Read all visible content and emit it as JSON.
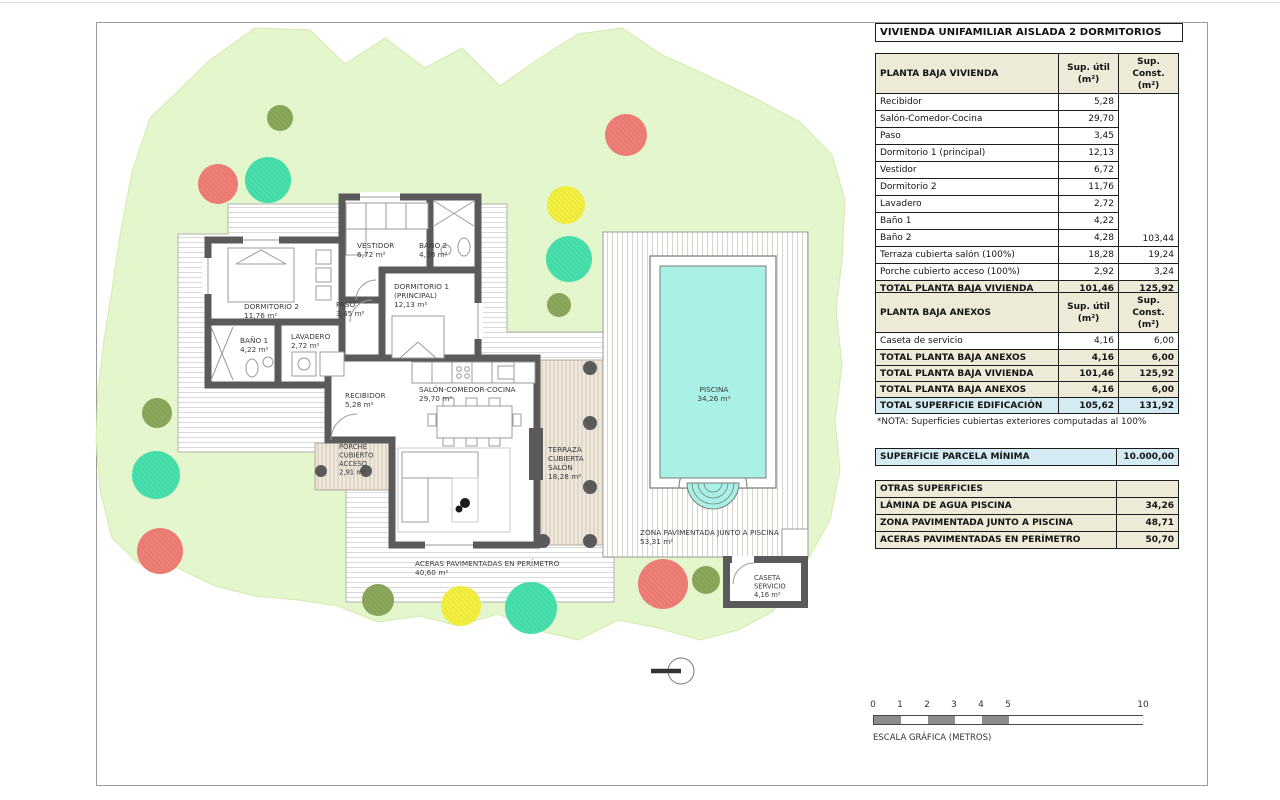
{
  "sheet": {
    "title": "VIVIENDA UNIFAMILIAR AISLADA 2 DORMITORIOS"
  },
  "tables": {
    "vivienda": {
      "widths": [
        183,
        60,
        60
      ],
      "header": [
        "PLANTA BAJA VIVIENDA",
        "Sup. útil\n(m²)",
        "Sup. Const.\n(m²)"
      ],
      "merge": {
        "col": 2,
        "rows": 9,
        "value": "103,44"
      },
      "rows": [
        {
          "c": [
            "Recibidor",
            "5,28",
            ""
          ]
        },
        {
          "c": [
            "Salón-Comedor-Cocina",
            "29,70",
            ""
          ]
        },
        {
          "c": [
            "Paso",
            "3,45",
            ""
          ]
        },
        {
          "c": [
            "Dormitorio 1 (principal)",
            "12,13",
            ""
          ]
        },
        {
          "c": [
            "Vestidor",
            "6,72",
            ""
          ]
        },
        {
          "c": [
            "Dormitorio 2",
            "11,76",
            ""
          ]
        },
        {
          "c": [
            "Lavadero",
            "2,72",
            ""
          ]
        },
        {
          "c": [
            "Baño 1",
            "4,22",
            ""
          ]
        },
        {
          "c": [
            "Baño 2",
            "4,28",
            ""
          ]
        },
        {
          "c": [
            "Terraza cubierta salón (100%)",
            "18,28",
            "19,24"
          ]
        },
        {
          "c": [
            "Porche cubierto acceso (100%)",
            "2,92",
            "3,24"
          ]
        },
        {
          "c": [
            "TOTAL PLANTA BAJA VIVIENDA",
            "101,46",
            "125,92"
          ],
          "s": "cream"
        }
      ]
    },
    "anexos": {
      "widths": [
        183,
        60,
        60
      ],
      "header": [
        "PLANTA BAJA ANEXOS",
        "Sup. útil\n(m²)",
        "Sup. Const.\n(m²)"
      ],
      "rows": [
        {
          "c": [
            "Caseta de servicio",
            "4,16",
            "6,00"
          ]
        },
        {
          "c": [
            "TOTAL PLANTA BAJA ANEXOS",
            "4,16",
            "6,00"
          ],
          "s": "cream"
        }
      ]
    },
    "totales": {
      "widths": [
        183,
        60,
        60
      ],
      "rows": [
        {
          "c": [
            "TOTAL PLANTA BAJA VIVIENDA",
            "101,46",
            "125,92"
          ],
          "s": "cream"
        },
        {
          "c": [
            "TOTAL PLANTA BAJA ANEXOS",
            "4,16",
            "6,00"
          ],
          "s": "cream"
        },
        {
          "c": [
            "TOTAL SUPERFICIE EDIFICACIÓN",
            "105,62",
            "131,92"
          ],
          "s": "blue"
        }
      ]
    },
    "parcela": {
      "widths": [
        241,
        62
      ],
      "rows": [
        {
          "c": [
            "SUPERFICIE PARCELA MÍNIMA",
            "10.000,00"
          ],
          "s": "blue"
        }
      ]
    },
    "otras": {
      "widths": [
        241,
        62
      ],
      "header": [
        "OTRAS SUPERFICIES",
        ""
      ],
      "rows": [
        {
          "c": [
            "LÁMINA DE AGUA PISCINA",
            "34,26"
          ],
          "s": "cream"
        },
        {
          "c": [
            "ZONA PAVIMENTADA JUNTO A PISCINA",
            "48,71"
          ],
          "s": "cream"
        },
        {
          "c": [
            "ACERAS PAVIMENTADAS EN PERÍMETRO",
            "50,70"
          ],
          "s": "cream"
        }
      ]
    }
  },
  "notes": {
    "nota": "*NOTA: Superficies cubiertas exteriores computadas al 100%"
  },
  "scale_bar": {
    "caption": "ESCALA GRÁFICA (METROS)",
    "px_per_m": 27,
    "ticks": [
      {
        "label": "0",
        "m": 0
      },
      {
        "label": "1",
        "m": 1
      },
      {
        "label": "2",
        "m": 2
      },
      {
        "label": "3",
        "m": 3
      },
      {
        "label": "4",
        "m": 4
      },
      {
        "label": "5",
        "m": 5
      },
      {
        "label": "10",
        "m": 10
      }
    ],
    "segments": [
      {
        "from": 0,
        "to": 1,
        "shade": "dark"
      },
      {
        "from": 1,
        "to": 2,
        "shade": "light"
      },
      {
        "from": 2,
        "to": 3,
        "shade": "dark"
      },
      {
        "from": 3,
        "to": 4,
        "shade": "light"
      },
      {
        "from": 4,
        "to": 5,
        "shade": "dark"
      },
      {
        "from": 5,
        "to": 10,
        "shade": "light"
      }
    ]
  },
  "plan": {
    "colors": {
      "garden": "#e4f6cb",
      "wall": "#5a5a5a",
      "water": "#a9f1e6",
      "cream_fill": "#edead8",
      "blue_fill": "#d4ebf4",
      "olive": "#8aa75a",
      "red": "#ee7e76",
      "teal": "#47e0ac",
      "yellow": "#f2ef3e"
    },
    "trees": [
      {
        "x": 280,
        "y": 118,
        "r": 13,
        "c": "olive"
      },
      {
        "x": 218,
        "y": 184,
        "r": 20,
        "c": "red"
      },
      {
        "x": 268,
        "y": 180,
        "r": 23,
        "c": "teal"
      },
      {
        "x": 626,
        "y": 135,
        "r": 21,
        "c": "red"
      },
      {
        "x": 566,
        "y": 205,
        "r": 19,
        "c": "yellow"
      },
      {
        "x": 569,
        "y": 259,
        "r": 23,
        "c": "teal"
      },
      {
        "x": 559,
        "y": 305,
        "r": 12,
        "c": "olive"
      },
      {
        "x": 157,
        "y": 413,
        "r": 15,
        "c": "olive"
      },
      {
        "x": 156,
        "y": 475,
        "r": 24,
        "c": "teal"
      },
      {
        "x": 160,
        "y": 551,
        "r": 23,
        "c": "red"
      },
      {
        "x": 378,
        "y": 600,
        "r": 16,
        "c": "olive"
      },
      {
        "x": 461,
        "y": 606,
        "r": 20,
        "c": "yellow"
      },
      {
        "x": 531,
        "y": 608,
        "r": 26,
        "c": "teal"
      },
      {
        "x": 663,
        "y": 584,
        "r": 25,
        "c": "red"
      },
      {
        "x": 706,
        "y": 580,
        "r": 14,
        "c": "olive"
      }
    ],
    "labels": [
      {
        "name": "label-dormitorio-2",
        "x": 244,
        "y": 309,
        "lines": [
          "DORMITORIO 2",
          "11,76 m²"
        ]
      },
      {
        "name": "label-bano-1",
        "x": 240,
        "y": 343,
        "lines": [
          "BAÑO 1",
          "4,22 m²"
        ]
      },
      {
        "name": "label-lavadero",
        "x": 291,
        "y": 339,
        "lines": [
          "LAVADERO",
          "2,72 m²"
        ]
      },
      {
        "name": "label-paso",
        "x": 336,
        "y": 307,
        "lines": [
          "PASO",
          "3,45 m²"
        ]
      },
      {
        "name": "label-vestidor",
        "x": 357,
        "y": 248,
        "lines": [
          "VESTIDOR",
          "6,72 m²"
        ]
      },
      {
        "name": "label-bano-2",
        "x": 419,
        "y": 248,
        "lines": [
          "BAÑO 2",
          "4,28 m²"
        ]
      },
      {
        "name": "label-dormitorio-1",
        "x": 394,
        "y": 289,
        "lines": [
          "DORMITORIO 1",
          "(PRINCIPAL)",
          "12,13 m²"
        ]
      },
      {
        "name": "label-recibidor",
        "x": 345,
        "y": 398,
        "lines": [
          "RECIBIDOR",
          "5,28 m²"
        ]
      },
      {
        "name": "label-salon",
        "x": 419,
        "y": 392,
        "lines": [
          "SALÓN-COMEDOR-COCINA",
          "29,70 m²"
        ]
      },
      {
        "name": "label-porche",
        "x": 339,
        "y": 449,
        "fs": 6.8,
        "dy": 8.5,
        "lines": [
          "PORCHE",
          "CUBIERTO",
          "ACCESO",
          "2,91 m²"
        ]
      },
      {
        "name": "label-terraza",
        "x": 548,
        "y": 452,
        "lines": [
          "TERRAZA",
          "CUBIERTA",
          "SALÓN",
          "18,28 m²"
        ]
      },
      {
        "name": "label-piscina",
        "x": 714,
        "y": 392,
        "anchor": "middle",
        "lines": [
          "PISCINA",
          "34,26 m²"
        ]
      },
      {
        "name": "label-zona-pavimentada",
        "x": 640,
        "y": 535,
        "lines": [
          "ZONA PAVIMENTADA JUNTO A PISCINA",
          "53,31 m²"
        ]
      },
      {
        "name": "label-aceras",
        "x": 415,
        "y": 566,
        "lines": [
          "ACERAS PAVIMENTADAS EN PERÍMETRO",
          "40,60 m²"
        ]
      },
      {
        "name": "label-caseta",
        "x": 754,
        "y": 580,
        "fs": 6.8,
        "dy": 8.5,
        "lines": [
          "CASETA",
          "SERVICIO",
          "4,16 m²"
        ]
      }
    ]
  }
}
